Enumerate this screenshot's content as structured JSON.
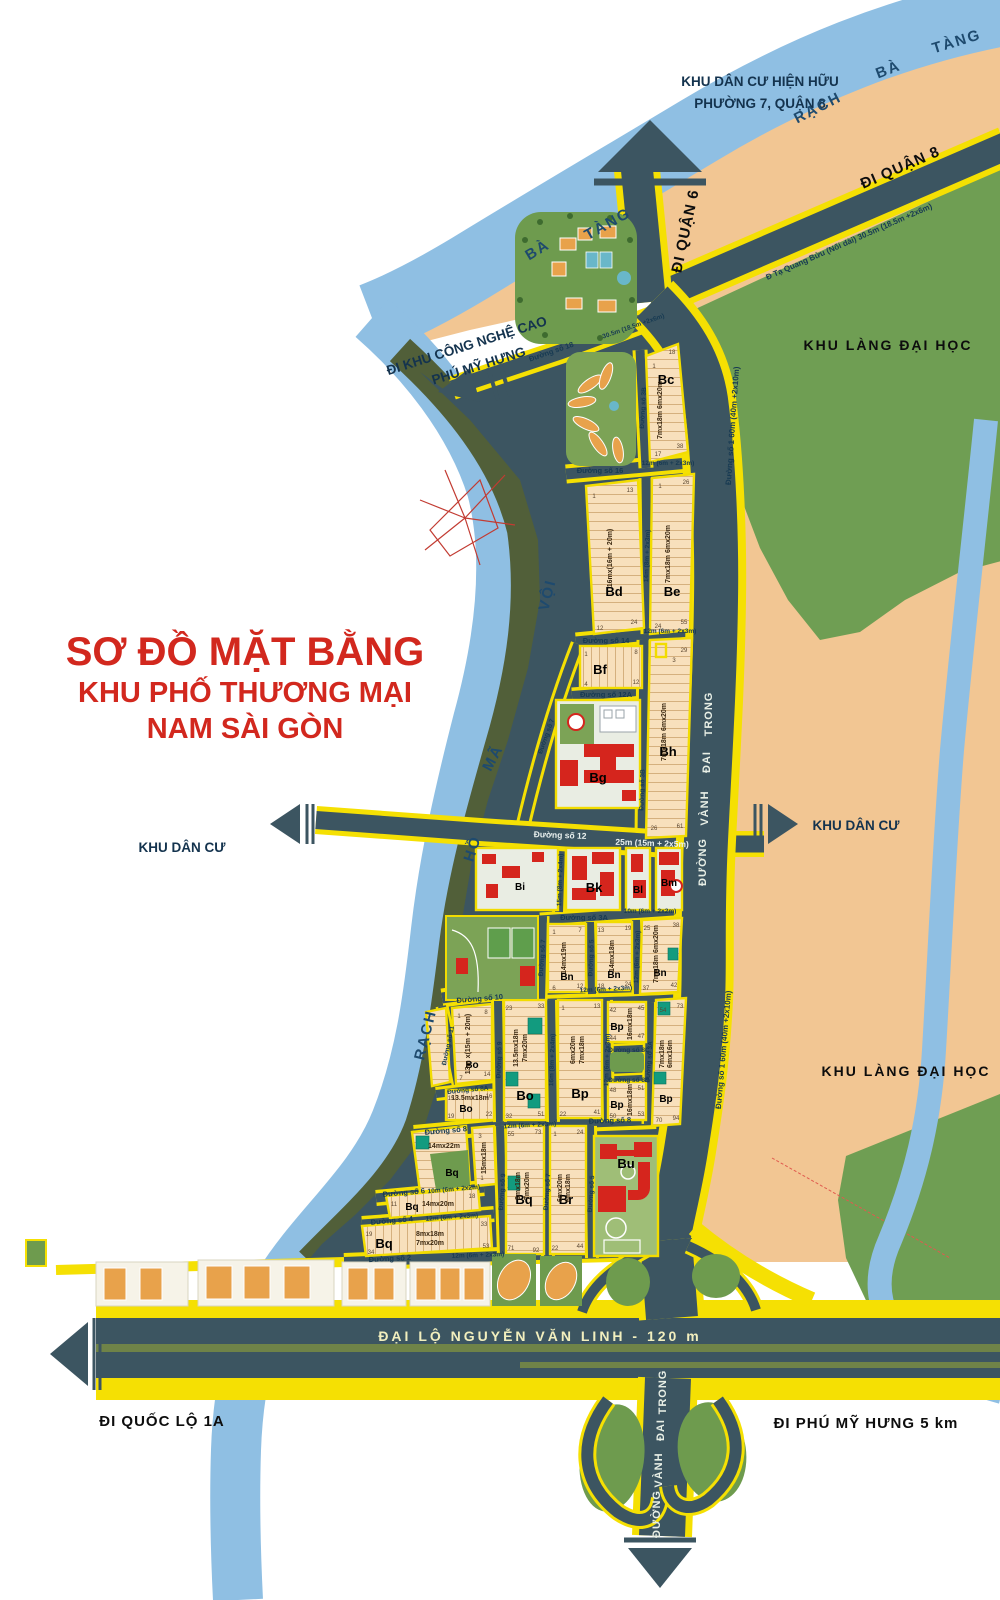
{
  "title": {
    "line1": "SƠ ĐỒ MẶT BẰNG",
    "line2": "KHU PHỐ THƯƠNG MẠI",
    "line3": "NAM SÀI GÒN",
    "color": "#D2281E"
  },
  "regions": {
    "existing_residential_1": "KHU DÂN CƯ HIỆN HỮU",
    "existing_residential_2": "PHƯỜNG 7, QUẬN 8",
    "university_village": "KHU LÀNG ĐẠI HỌC",
    "residential": "KHU DÂN CƯ"
  },
  "rivers": {
    "rach": "RẠCH",
    "ba": "BÀ",
    "tang": "TÀNG",
    "voi": "VỘI",
    "ma": "MÃ",
    "ho": "HỒ"
  },
  "directions": {
    "quan6": "ĐI QUẬN 6",
    "quan8": "ĐI QUẬN 8",
    "cnc1": "ĐI KHU CÔNG NGHỆ CAO",
    "cnc2": "PHÚ MỸ HƯNG",
    "ql1a": "ĐI QUỐC LỘ 1A",
    "pmh": "ĐI PHÚ MỸ HƯNG 5 km"
  },
  "main_roads": {
    "nvl": "ĐẠI LỘ  NGUYỄN  VĂN  LINH  -  120 m",
    "vdt": {
      "w1": "ĐƯỜNG",
      "w2": "VÀNH",
      "w3": "ĐAI",
      "w4": "TRONG"
    },
    "tqb": "Đ Tạ Quang Bửu  (Nối dài)   30.5m (18.5m +2x6m)",
    "d1": "Đường số 1   60m (40m +2x10m)"
  },
  "streets": {
    "s18": "Đường số 18",
    "s18w": "30.5m (18.5m +2x6m)",
    "s16": "Đường số 16",
    "s14": "Đường số 14",
    "s12a": "Đường số 12A",
    "s12": "Đường số 12",
    "s12w": "25m (15m + 2x5m)",
    "s10": "Đường số 10",
    "s8": "Đường số 8",
    "s8a": "Đường số 8A",
    "s8b": "Đường số 8B",
    "s8c": "Đường số 8C",
    "s6": "Đường số 6",
    "s6w": "10m (6m + 2x2m)",
    "s4": "Đường số 4",
    "s2": "Đường số 2",
    "s3a": "Đường số 3A",
    "s3aw": "10m (6m + 2x2m)",
    "s3b": "Đường số 3B",
    "s5": "Đường số 5",
    "s7": "Đường số 7",
    "s9": "Đường số 9",
    "s11": "Đường số 11",
    "w12": "12m (6m + 2x3m)",
    "w14": "14m (8m + 2x3m)",
    "w15": "15m (8m + 2x4m)",
    "w16": "16m (8m + 2x4m)"
  },
  "blocks": {
    "bc": {
      "label": "Bc",
      "dims": "7mx18m  6mx20m",
      "lots": "1,18,20,3,25,10,30,15,35,17,38",
      "c": [
        "1",
        "18",
        "17",
        "38"
      ]
    },
    "bd": {
      "label": "Bd",
      "dims": "16mx(16m + 20m)",
      "lots": "1,13,16,20,10,12,24",
      "c": [
        "1",
        "13",
        "12",
        "24"
      ]
    },
    "be": {
      "label": "Be",
      "dims": "7mx18m  6mx20m",
      "lots": "1,26,3,30,7,35,10,15,45,20,50,23,24,25,55",
      "c": [
        "1",
        "26",
        "24",
        "55"
      ]
    },
    "bf": {
      "label": "Bf",
      "lots": "1,3,8,4,7,12",
      "c": [
        "1",
        "8",
        "4",
        "12"
      ]
    },
    "bg": {
      "label": "Bg"
    },
    "bh": {
      "label": "Bh",
      "dims": "7mx18m  6mx20m",
      "lots": "29,3,35,10,40,15,45,20,50,55,26,27,28,61",
      "c": [
        "29",
        "3",
        "26",
        "61"
      ]
    },
    "bi": {
      "label": "Bi"
    },
    "bk": {
      "label": "Bk"
    },
    "bl": {
      "label": "Bl"
    },
    "bm": {
      "label": "Bm"
    },
    "bn1": {
      "label": "Bn",
      "dims": "14mx19m",
      "lots": "1,7,6,12",
      "c": [
        "1",
        "7",
        "6",
        "12"
      ]
    },
    "bn2": {
      "label": "Bn",
      "dims": "14mx18m",
      "lots": "13,19,18,24",
      "c": [
        "13",
        "19",
        "18",
        "24"
      ]
    },
    "bn3": {
      "label": "Bn",
      "dims": "7mx18m  6mx20m",
      "lots": "25,38,30,40,35,45,50,36,37,42",
      "c": [
        "25",
        "38",
        "37",
        "42"
      ]
    },
    "bo1": {
      "label": "Bo",
      "dims": "13m x(15m + 20m)",
      "lots": "1,8,7,14",
      "c": [
        "1",
        "8",
        "7",
        "14"
      ]
    },
    "bo2": {
      "label": "Bo",
      "dims1": "13.5mx18m",
      "dims2": "7mx20m",
      "lots": "23,33,35,27,37,40,42,45,30,47,48,49,32,51",
      "c": [
        "23",
        "33",
        "32",
        "51"
      ]
    },
    "bo3": {
      "label": "Bo",
      "dims": "13.5mx18m",
      "lots": "15,16,19,22",
      "c": [
        "15",
        "16",
        "19",
        "22"
      ]
    },
    "bp1": {
      "label": "Bp",
      "dims1": "6mx20m",
      "dims2": "7mx18m",
      "lots": "1,13,25,15,35,20,41,22",
      "c": [
        "1",
        "13",
        "22",
        "41"
      ]
    },
    "bp2": {
      "label": "Bp",
      "dims": "16mx18m",
      "lots": "42,45,44,47",
      "c": [
        "42",
        "45",
        "44",
        "47"
      ]
    },
    "bp3": {
      "label": "Bp",
      "dims": "16mx18m",
      "lots": "48,51,50,53",
      "c": [
        "48",
        "51",
        "50",
        "53"
      ]
    },
    "bp4": {
      "label": "Bp",
      "dims1": "7mx18m",
      "dims2": "6mx16m",
      "lots": "54,73,55,56,60,65,85,89,90,70,72,94",
      "c": [
        "54",
        "73",
        "70",
        "94"
      ]
    },
    "bq1": {
      "label": "Bq",
      "dims": "14mx22m"
    },
    "bq5": {
      "dims": "15mx18m",
      "lots": "3,2,1",
      "c": [
        "3",
        "1"
      ]
    },
    "bq2": {
      "label": "Bq",
      "dims": "14mx20m",
      "lots": "11,18",
      "c": [
        "11",
        "18"
      ]
    },
    "bq3": {
      "label": "Bq",
      "dims1": "8mx18m",
      "dims2": "7mx20m",
      "lots": "19,33,34,40,45,50,53",
      "c": [
        "19",
        "33",
        "34",
        "53"
      ]
    },
    "bq4": {
      "label": "Bq",
      "dims1": "8mx18m",
      "dims2": "7mx20m",
      "lots": "55,73,75,60,62,69,70,71,92",
      "c": [
        "55",
        "73",
        "71",
        "92"
      ]
    },
    "br": {
      "label": "Br",
      "dims1": "6mx20m",
      "dims2": "6mx18m",
      "lots": "1,23,24,5,27,30,10,35,15,40,20,43,44,46,22,48",
      "c": [
        "1",
        "24",
        "22",
        "44"
      ]
    },
    "bu": {
      "label": "Bu"
    }
  },
  "colors": {
    "accent_red": "#D2281E",
    "road_dark": "#3C5561",
    "road_yellow": "#F5E003",
    "river_blue": "#8FBFE3",
    "parcel_peach": "#F8E0BC",
    "tan": "#F2C693",
    "green": "#6E9B4E",
    "teal_lot": "#129B7F"
  }
}
